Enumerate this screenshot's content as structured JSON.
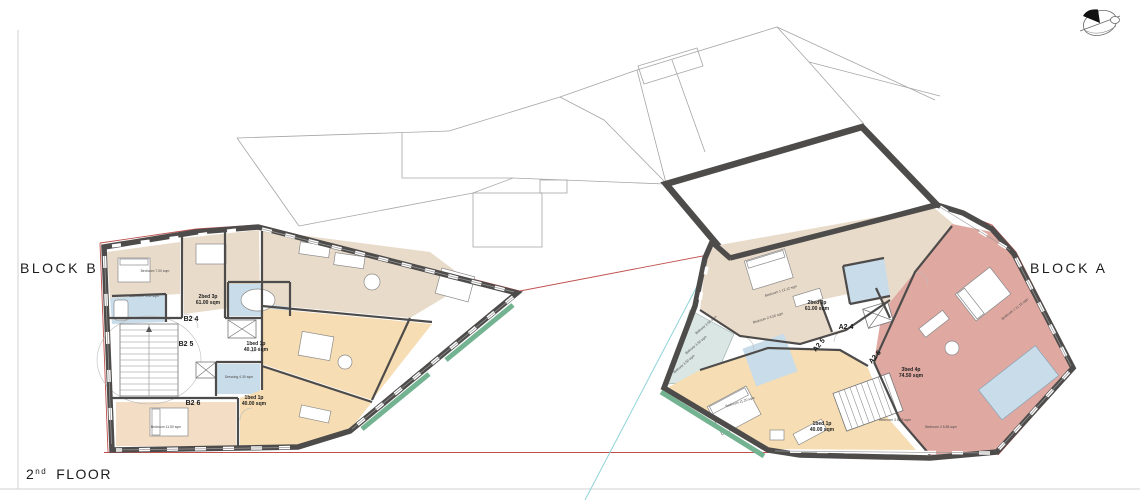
{
  "labels": {
    "block_b": "BLOCK B",
    "block_a": "BLOCK A",
    "floor_number": "2",
    "floor_ordinal": "nd",
    "floor_word": "FLOOR"
  },
  "block_b": {
    "units": [
      {
        "id": "B2 4",
        "type": "2bed 3p",
        "area": "61.00 sqm"
      },
      {
        "id": "B2 5",
        "type": "1bed 1p",
        "area": "40.10 sqm"
      },
      {
        "id": "B2 6",
        "type": "1bed 1p",
        "area": "40.00 sqm"
      }
    ],
    "rooms": [
      {
        "label": "Bedroom 7.00 sqm"
      },
      {
        "label": "Bathroom 4.00 sqm"
      },
      {
        "label": "Dressing 4.30 sqm"
      },
      {
        "label": "Bedroom 11.50 sqm"
      }
    ]
  },
  "block_a": {
    "units": [
      {
        "id": "A2 4",
        "type": "2bed 3p",
        "area": "61.00 sqm"
      },
      {
        "id": "A2 5"
      },
      {
        "id": "A2 6"
      },
      {
        "type": "3bed 4p",
        "area": "74.50 sqm"
      },
      {
        "type": "1bed 1p",
        "area": "40.00 sqm"
      }
    ],
    "rooms": [
      {
        "label": "Bedroom 1 12.12 sqm"
      },
      {
        "label": "Bedroom 2 8.50 sqm"
      },
      {
        "label": "Bedroom 11.20 sqm"
      },
      {
        "label": "Bedroom 1 11.16 sqm"
      },
      {
        "label": "Bedroom 3 8.45 sqm"
      },
      {
        "label": "Bedroom 2 8.85 sqm"
      }
    ],
    "balconies": [
      "Balcony 3.50 sqm",
      "Balcony 3.50 sqm",
      "Balcony 3.50 sqm"
    ]
  },
  "colors": {
    "wall": "#4e4c4b",
    "tan": "#e9dbca",
    "orange": "#f6ddb3",
    "peach": "#f3ddc4",
    "pink": "#dfa9a1",
    "blue": "#c9dce9",
    "teal": "#d9e6e3",
    "green": "#74b391",
    "red": "#c0504d",
    "cyan": "#8fd3d8",
    "outline": "#a6a6a6"
  }
}
